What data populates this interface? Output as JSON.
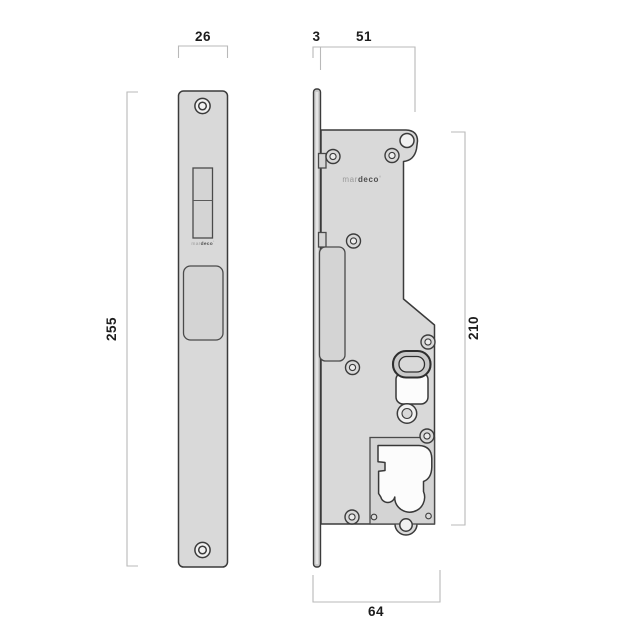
{
  "drawing": {
    "brand": {
      "prefix": "mar",
      "suffix": "deco",
      "mark": "°"
    },
    "dimensions": {
      "front_width": "26",
      "front_height": "255",
      "faceplate_thickness": "3",
      "body_depth": "51",
      "body_height": "210",
      "overall_depth": "64"
    },
    "colors": {
      "background": "#ffffff",
      "part_fill": "#d9d9d9",
      "part_fill_dark": "#c8c8c8",
      "detail_fill": "#d4d4d4",
      "cutout_fill": "#fcfcfc",
      "part_outline": "#3b3b3b",
      "dimension_line": "#b9b9b9",
      "dimension_text": "#1d1d1d",
      "brand_light": "#9a9a9a",
      "brand_dark": "#4f4f4f"
    }
  }
}
